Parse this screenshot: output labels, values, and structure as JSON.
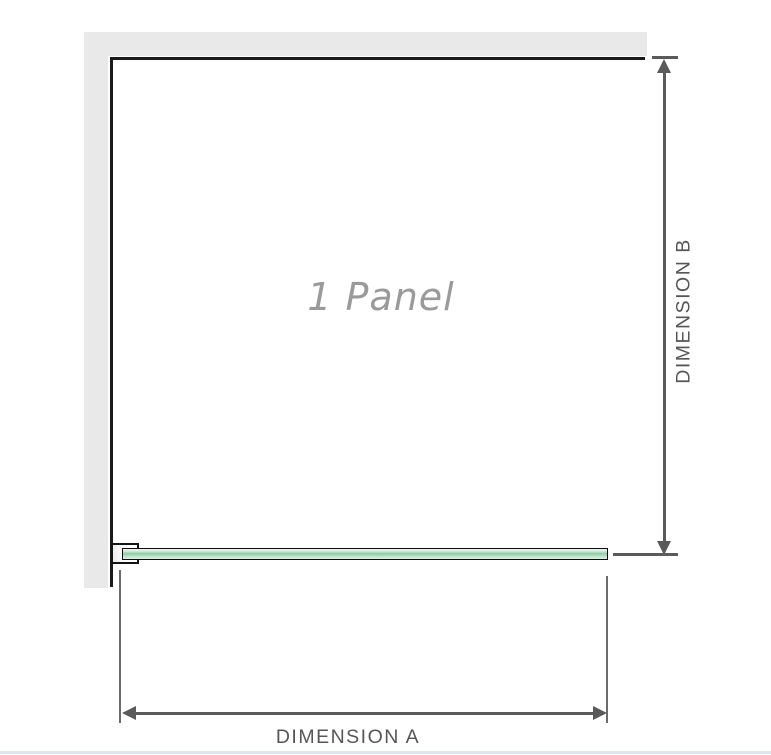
{
  "diagram": {
    "panel": {
      "label": "1 Panel"
    },
    "dimension_a": {
      "label": "DIMENSION A"
    },
    "dimension_b": {
      "label": "DIMENSION B"
    },
    "colors": {
      "wall_fill": "#e9e9e9",
      "wall_face_line": "#1a1a1a",
      "dimension_line": "#5a5a5a",
      "dimension_text": "#565656",
      "panel_label_text": "#9a9a9a",
      "glass_fill": "#b9e0c6",
      "glass_highlight": "#eef7f0",
      "glass_shade": "#8fcba4",
      "glass_border": "#0d0d0d",
      "bracket_border": "#141414",
      "footer_divider": "#dde5f1"
    }
  }
}
